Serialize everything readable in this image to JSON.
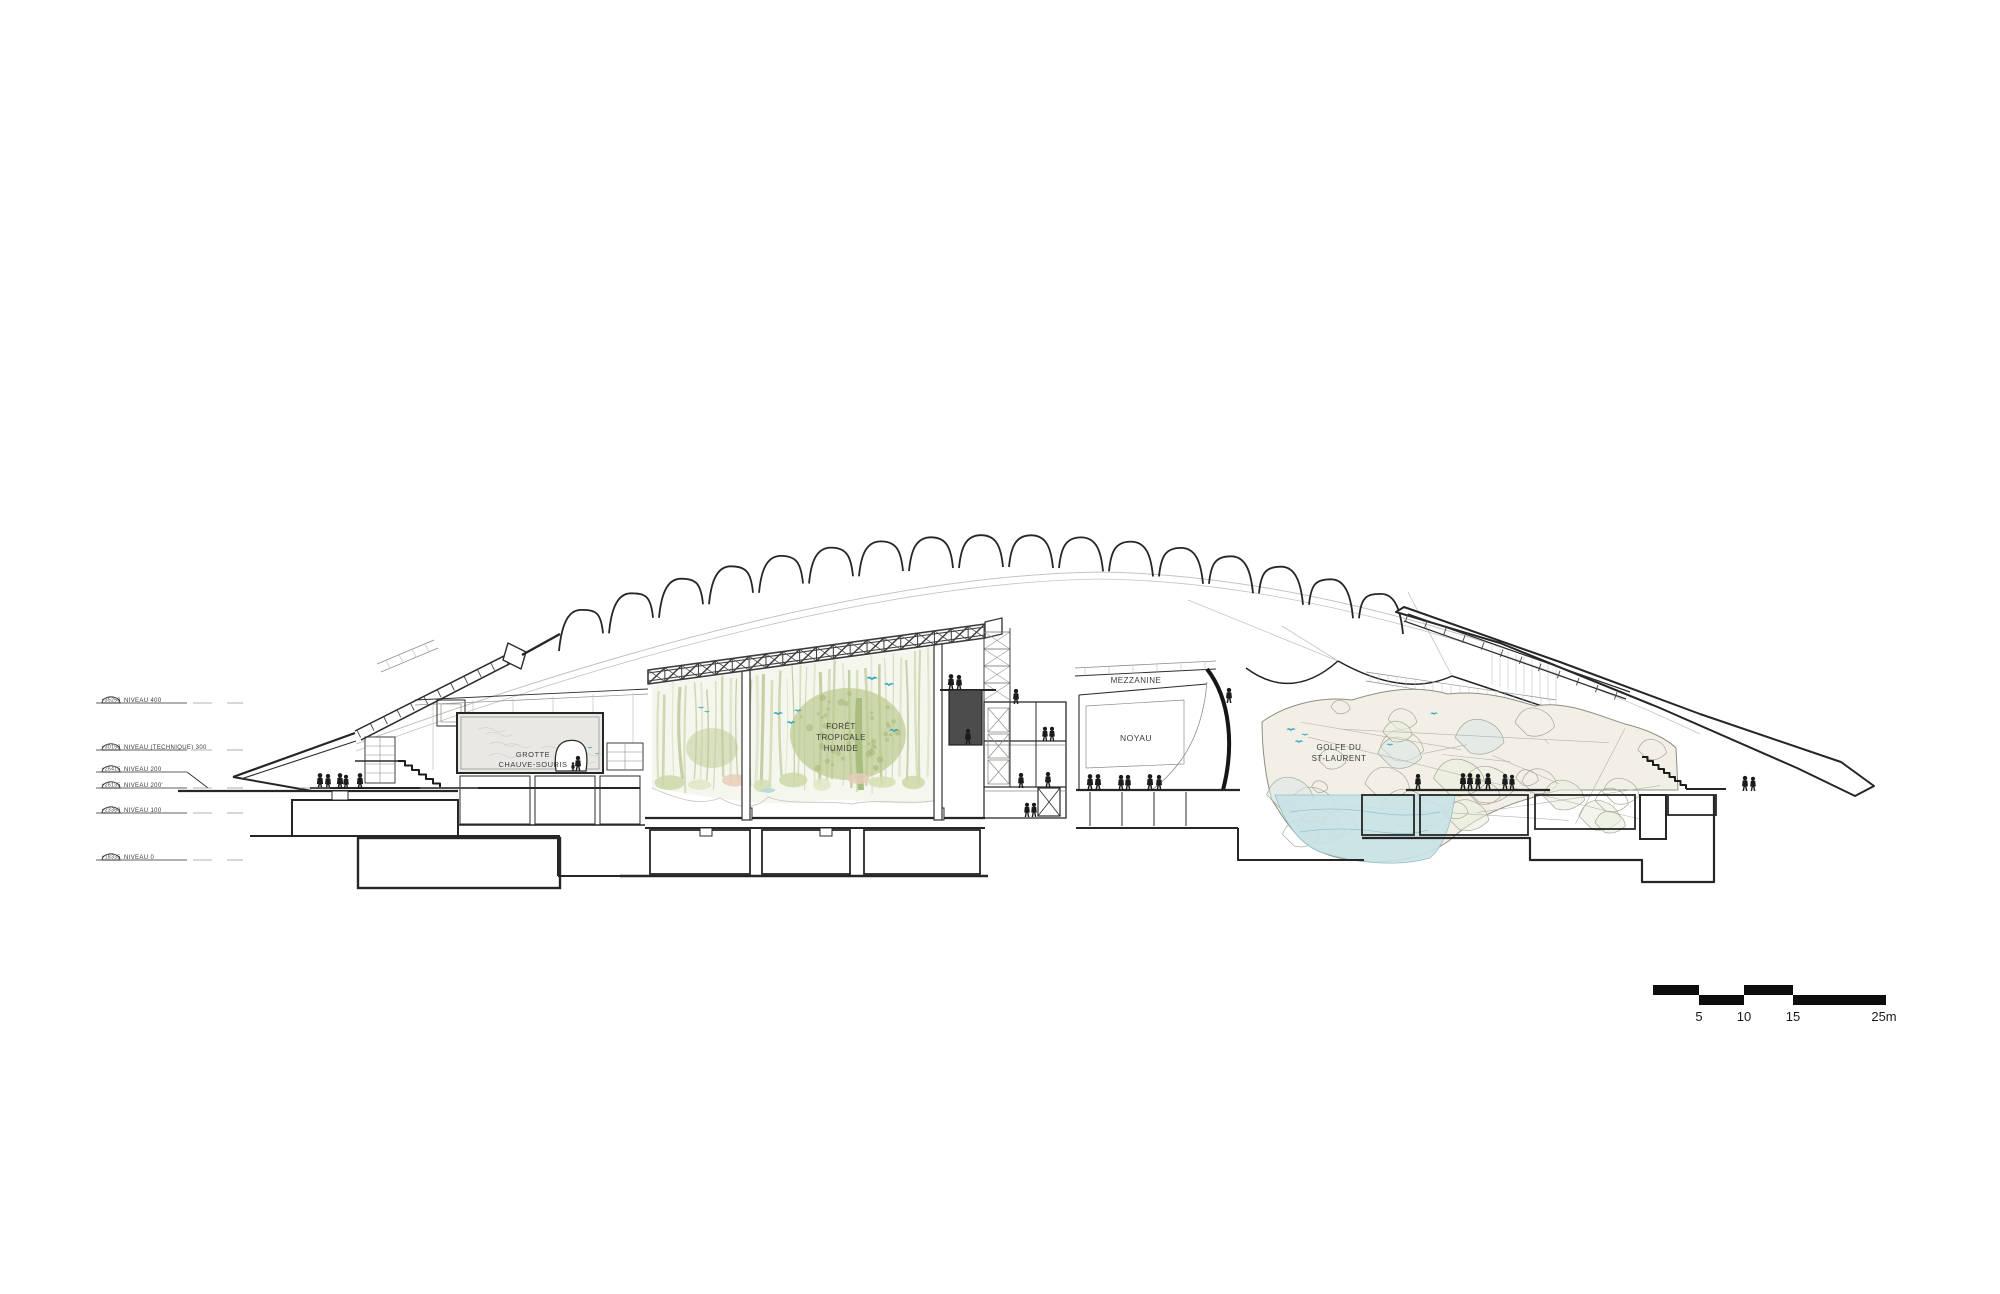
{
  "drawing": {
    "type": "architectural-long-section",
    "levels": {
      "items": [
        {
          "elevation": "+35250",
          "name": "NIVEAU 400"
        },
        {
          "elevation": "+30150",
          "name": "NIVEAU (TECHNIQUE) 300"
        },
        {
          "elevation": "+26415",
          "name": "NIVEAU 200"
        },
        {
          "elevation": "+26135",
          "name": "NIVEAU 200'"
        },
        {
          "elevation": "+23380",
          "name": "NIVEAU 100"
        },
        {
          "elevation": "+18335",
          "name": "NIVEAU 0"
        }
      ]
    },
    "rooms": {
      "grotte_line1": "GROTTE",
      "grotte_line2": "CHAUVE-SOURIS",
      "foret_line1": "FORÊT",
      "foret_line2": "TROPICALE",
      "foret_line3": "HUMIDE",
      "mezzanine": "MEZZANINE",
      "noyau": "NOYAU",
      "golfe_line1": "GOLFE DU",
      "golfe_line2": "ST-LAURENT"
    },
    "scalebar": {
      "labels": [
        "5",
        "10",
        "15",
        "25m"
      ]
    },
    "colors": {
      "line": "#2b2b2b",
      "light_line": "#c2c2bc",
      "forest_green": "#bcca92",
      "bird_teal": "#3aa6bd",
      "water_blue": "#c9e3e6",
      "rock_fill": "#f2f0e6",
      "dark_box": "#4c4c4c",
      "truss": "#3c3c3c"
    }
  }
}
